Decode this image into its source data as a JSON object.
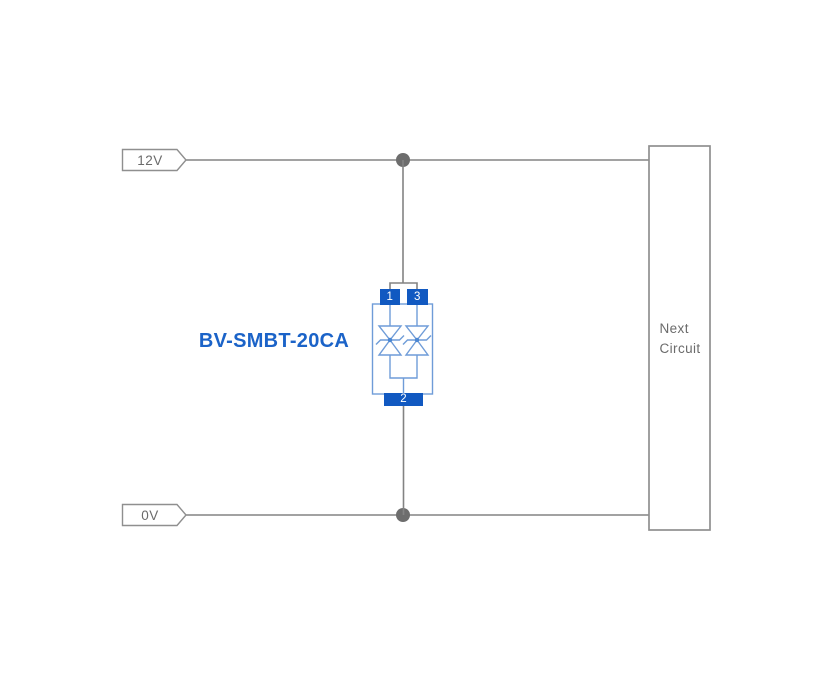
{
  "labels": {
    "top_rail": "12V",
    "bottom_rail": "0V",
    "component": "BV-SMBT-20CA",
    "next_circuit_line1": "Next",
    "next_circuit_line2": "Circuit"
  },
  "component": {
    "name": "BV-SMBT-20CA",
    "pins": {
      "pin1": "1",
      "pin2": "2",
      "pin3": "3"
    }
  },
  "colors": {
    "background": "#ffffff",
    "wire": "#838383",
    "junction_dot": "#6d6d6d",
    "outline_gray": "#8f8f8f",
    "text_gray": "#6b6b6b",
    "component_blue": "#6f9cd8",
    "component_dot": "#4b87d3",
    "pin_blue": "#1159c1",
    "label_blue": "#1b63c8"
  }
}
